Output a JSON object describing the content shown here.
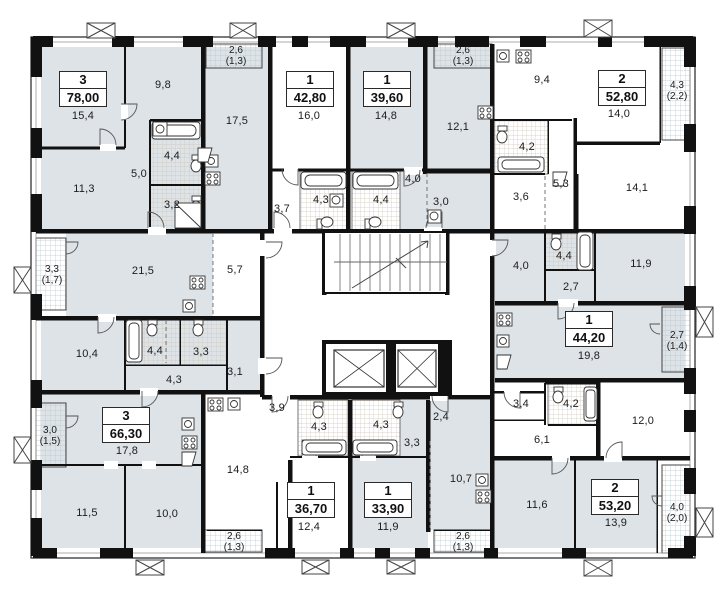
{
  "plan": {
    "name": "Типовой этаж — план",
    "colors": {
      "wall": "#111111",
      "room_fill": "#dde3e7",
      "balcony_grid": "#b9c6cf",
      "bath_grid": "#cfc7bd",
      "text": "#1c1c1c"
    }
  },
  "apartments": [
    {
      "rooms": "3",
      "area": "78,00",
      "x": 83,
      "y": 89
    },
    {
      "rooms": "1",
      "area": "42,80",
      "x": 310,
      "y": 89
    },
    {
      "rooms": "1",
      "area": "39,60",
      "x": 387,
      "y": 89
    },
    {
      "rooms": "2",
      "area": "52,80",
      "x": 622,
      "y": 88
    },
    {
      "rooms": "1",
      "area": "44,20",
      "x": 589,
      "y": 329
    },
    {
      "rooms": "3",
      "area": "66,30",
      "x": 126,
      "y": 425
    },
    {
      "rooms": "1",
      "area": "36,70",
      "x": 311,
      "y": 500
    },
    {
      "rooms": "1",
      "area": "33,90",
      "x": 388,
      "y": 500
    },
    {
      "rooms": "2",
      "area": "53,20",
      "x": 615,
      "y": 497
    }
  ],
  "rooms": [
    {
      "t": "15,4",
      "x": 83,
      "y": 116
    },
    {
      "t": "9,8",
      "x": 163,
      "y": 85
    },
    {
      "t": "11,3",
      "x": 84,
      "y": 189
    },
    {
      "t": "5,0",
      "x": 139,
      "y": 174
    },
    {
      "t": "4,4",
      "x": 172,
      "y": 156
    },
    {
      "t": "3,2",
      "x": 172,
      "y": 205
    },
    {
      "t": "17,5",
      "x": 237,
      "y": 121
    },
    {
      "t": "16,0",
      "x": 309,
      "y": 116
    },
    {
      "t": "3,7",
      "x": 282,
      "y": 209
    },
    {
      "t": "4,3",
      "x": 321,
      "y": 200
    },
    {
      "t": "14,8",
      "x": 386,
      "y": 116
    },
    {
      "t": "4,4",
      "x": 381,
      "y": 200
    },
    {
      "t": "4,0",
      "x": 413,
      "y": 179
    },
    {
      "t": "3,0",
      "x": 441,
      "y": 202
    },
    {
      "t": "12,1",
      "x": 458,
      "y": 127
    },
    {
      "t": "9,4",
      "x": 542,
      "y": 80
    },
    {
      "t": "4,2",
      "x": 527,
      "y": 147
    },
    {
      "t": "3,6",
      "x": 521,
      "y": 197
    },
    {
      "t": "5,3",
      "x": 561,
      "y": 184
    },
    {
      "t": "14,0",
      "x": 619,
      "y": 114
    },
    {
      "t": "14,1",
      "x": 637,
      "y": 188
    },
    {
      "t": "21,5",
      "x": 143,
      "y": 271
    },
    {
      "t": "5,7",
      "x": 235,
      "y": 270
    },
    {
      "t": "10,4",
      "x": 87,
      "y": 354
    },
    {
      "t": "4,4",
      "x": 155,
      "y": 351
    },
    {
      "t": "3,3",
      "x": 201,
      "y": 352
    },
    {
      "t": "4,3",
      "x": 174,
      "y": 380
    },
    {
      "t": "3,1",
      "x": 235,
      "y": 372
    },
    {
      "t": "4,0",
      "x": 521,
      "y": 266
    },
    {
      "t": "4,4",
      "x": 564,
      "y": 256
    },
    {
      "t": "2,7",
      "x": 571,
      "y": 287
    },
    {
      "t": "11,9",
      "x": 641,
      "y": 264
    },
    {
      "t": "19,8",
      "x": 589,
      "y": 356
    },
    {
      "t": "17,8",
      "x": 127,
      "y": 451
    },
    {
      "t": "11,5",
      "x": 87,
      "y": 513
    },
    {
      "t": "10,0",
      "x": 167,
      "y": 514
    },
    {
      "t": "14,8",
      "x": 238,
      "y": 470
    },
    {
      "t": "3,9",
      "x": 277,
      "y": 408
    },
    {
      "t": "4,3",
      "x": 319,
      "y": 427
    },
    {
      "t": "4,3",
      "x": 381,
      "y": 425
    },
    {
      "t": "2,4",
      "x": 441,
      "y": 417
    },
    {
      "t": "3,3",
      "x": 412,
      "y": 443
    },
    {
      "t": "12,4",
      "x": 309,
      "y": 527
    },
    {
      "t": "11,9",
      "x": 388,
      "y": 527
    },
    {
      "t": "10,7",
      "x": 461,
      "y": 479
    },
    {
      "t": "3,4",
      "x": 521,
      "y": 404
    },
    {
      "t": "4,2",
      "x": 571,
      "y": 404
    },
    {
      "t": "6,1",
      "x": 542,
      "y": 440
    },
    {
      "t": "12,0",
      "x": 643,
      "y": 421
    },
    {
      "t": "11,6",
      "x": 537,
      "y": 505
    },
    {
      "t": "13,9",
      "x": 616,
      "y": 523
    }
  ],
  "balconies": [
    {
      "l1": "2,6",
      "l2": "(1,3)",
      "x": 236,
      "y": 56
    },
    {
      "l1": "2,6",
      "l2": "(1,3)",
      "x": 463,
      "y": 56
    },
    {
      "l1": "4,3",
      "l2": "(2,2)",
      "x": 677,
      "y": 91
    },
    {
      "l1": "3,3",
      "l2": "(1,7)",
      "x": 52,
      "y": 275
    },
    {
      "l1": "2,7",
      "l2": "(1,4)",
      "x": 677,
      "y": 341
    },
    {
      "l1": "3,0",
      "l2": "(1,5)",
      "x": 50,
      "y": 436
    },
    {
      "l1": "2,6",
      "l2": "(1,3)",
      "x": 234,
      "y": 542
    },
    {
      "l1": "2,6",
      "l2": "(1,3)",
      "x": 463,
      "y": 542
    },
    {
      "l1": "4,0",
      "l2": "(2,0)",
      "x": 677,
      "y": 513
    }
  ]
}
